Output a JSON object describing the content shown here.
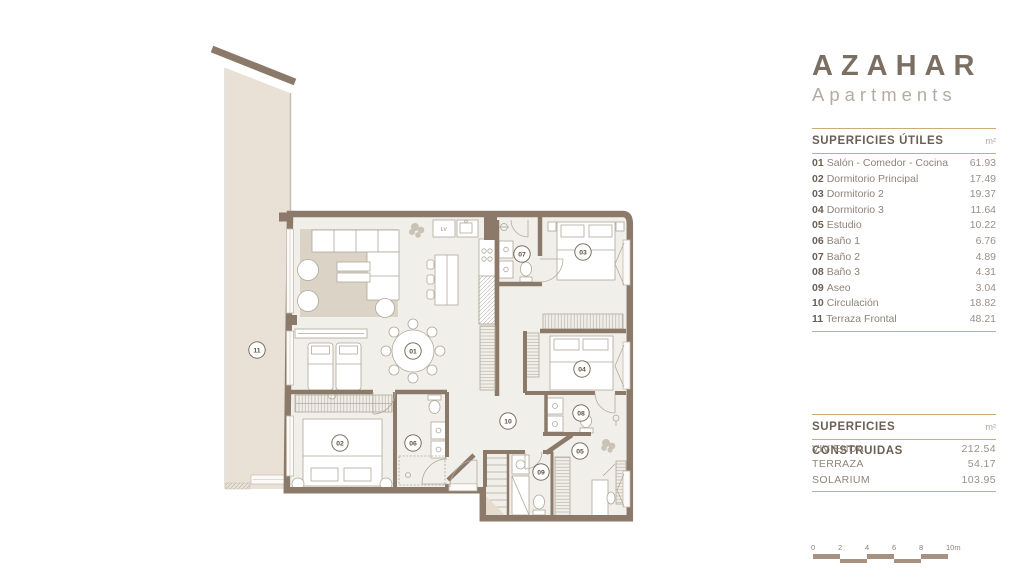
{
  "brand": {
    "title": "AZAHAR",
    "subtitle": "Apartments"
  },
  "superficies_utiles": {
    "title": "SUPERFICIES ÚTILES",
    "unit": "m²",
    "rows": [
      {
        "num": "01",
        "label": "Salón - Comedor - Cocina",
        "value": "61.93"
      },
      {
        "num": "02",
        "label": "Dormitorio Principal",
        "value": "17.49"
      },
      {
        "num": "03",
        "label": "Dormitorio 2",
        "value": "19.37"
      },
      {
        "num": "04",
        "label": "Dormitorio 3",
        "value": "11.64"
      },
      {
        "num": "05",
        "label": "Estudio",
        "value": "10.22"
      },
      {
        "num": "06",
        "label": "Baño 1",
        "value": "6.76"
      },
      {
        "num": "07",
        "label": "Baño 2",
        "value": "4.89"
      },
      {
        "num": "08",
        "label": "Baño 3",
        "value": "4.31"
      },
      {
        "num": "09",
        "label": "Aseo",
        "value": "3.04"
      },
      {
        "num": "10",
        "label": "Circulación",
        "value": "18.82"
      },
      {
        "num": "11",
        "label": "Terraza Frontal",
        "value": "48.21"
      }
    ]
  },
  "superficies_construidas": {
    "title": "SUPERFICIES CONSTRUIDAS",
    "unit": "m²",
    "rows": [
      {
        "label": "VIVIENDA",
        "value": "212.54"
      },
      {
        "label": "TERRAZA",
        "value": "54.17"
      },
      {
        "label": "SOLARIUM",
        "value": "103.95"
      }
    ]
  },
  "scale_bar": {
    "ticks": [
      "0",
      "2",
      "4",
      "6",
      "8",
      "10m"
    ],
    "step_px": 27
  },
  "floor_plan": {
    "annotations": {
      "lv": "LV"
    },
    "labels": [
      {
        "num": "01",
        "room": "salon-comedor-cocina"
      },
      {
        "num": "02",
        "room": "dormitorio-principal"
      },
      {
        "num": "03",
        "room": "dormitorio-2"
      },
      {
        "num": "04",
        "room": "dormitorio-3"
      },
      {
        "num": "05",
        "room": "estudio"
      },
      {
        "num": "06",
        "room": "bano-1"
      },
      {
        "num": "07",
        "room": "bano-2"
      },
      {
        "num": "08",
        "room": "bano-3"
      },
      {
        "num": "09",
        "room": "aseo"
      },
      {
        "num": "10",
        "room": "circulacion"
      },
      {
        "num": "11",
        "room": "terraza-frontal"
      }
    ]
  },
  "colors": {
    "wall": "#8b7a6a",
    "terrace_fill": "#e9e1d5",
    "floor_fill": "#f1efe9",
    "rug": "#dbd3c5",
    "accent_line": "#cbab7a",
    "title": "#7b6f63",
    "subtitle": "#b4aca1"
  }
}
